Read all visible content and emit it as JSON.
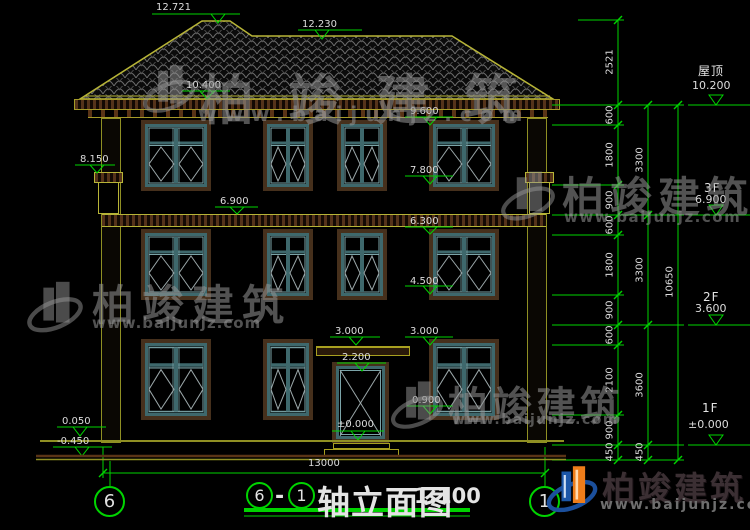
{
  "drawing": {
    "title": {
      "axis_start": "6",
      "separator": "-",
      "axis_end": "1",
      "name": "轴立面图",
      "scale": "1:100"
    },
    "axis_bubbles": {
      "left": "6",
      "right": "1"
    },
    "overall_width_dim": "13000"
  },
  "level_markers": [
    "12.721",
    "12.230",
    "10.400",
    "9.600",
    "8.150",
    "6.900",
    "7.800",
    "6.300",
    "4.500",
    "3.000",
    "3.000",
    "2.200",
    "0.900",
    "±0.000",
    "0.050",
    "-0.450"
  ],
  "right_panel": {
    "chain_inner": [
      "2521",
      "600",
      "1800",
      "900",
      "600",
      "1800",
      "900",
      "600",
      "2100",
      "900",
      "450"
    ],
    "chain_mid": [
      "3300",
      "3300",
      "3600",
      "450"
    ],
    "chain_outer": [
      "10650"
    ],
    "floors": [
      {
        "name": "屋顶",
        "elev": "10.200"
      },
      {
        "name": "3F",
        "elev": "6.900"
      },
      {
        "name": "2F",
        "elev": "3.600"
      },
      {
        "name": "1F",
        "elev": "±0.000"
      }
    ]
  },
  "watermark": {
    "brand": "柏竣建筑",
    "url": "www.baijunjz.com"
  },
  "colors": {
    "dim_green": "#00d400",
    "cad_yellow": "#b7b437",
    "frame_brown": "#46301c",
    "sash_teal": "#3e686c",
    "logo_blue": "#1c57a8",
    "logo_orange": "#ef7d1a"
  }
}
